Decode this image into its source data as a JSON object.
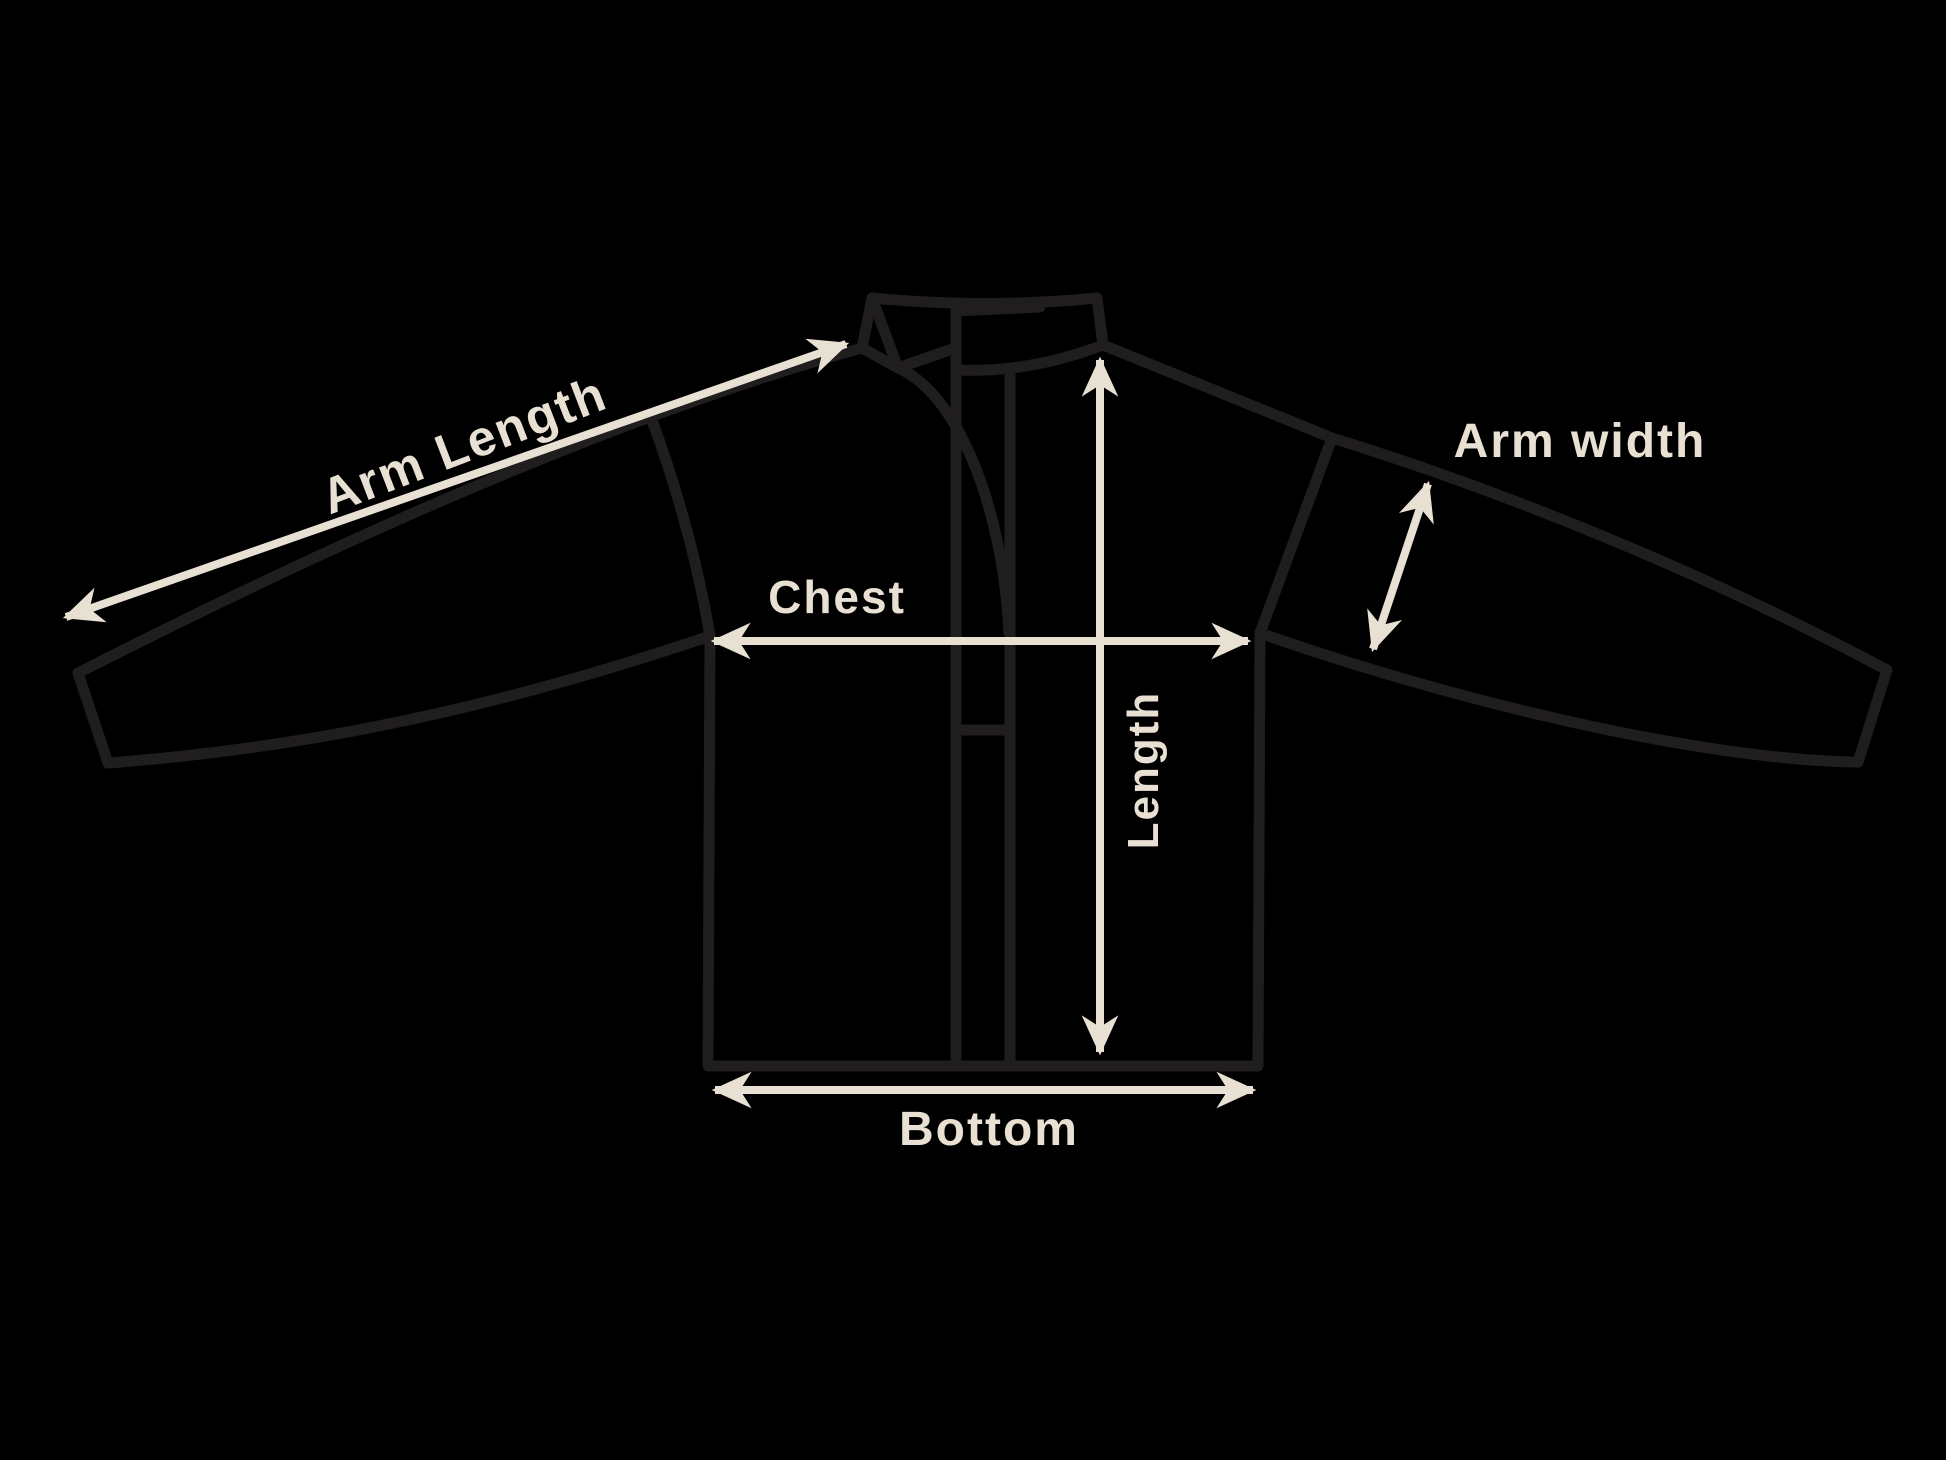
{
  "diagram": {
    "title": "Jacket measurement diagram",
    "colors": {
      "background": "#000000",
      "outline": "#201d1e",
      "accent": "#e8e1d3"
    },
    "labels": {
      "arm_length": {
        "text": "Arm Length"
      },
      "arm_width": {
        "text": "Arm width"
      },
      "chest": {
        "text": "Chest"
      },
      "length": {
        "text": "Length"
      },
      "bottom": {
        "text": "Bottom"
      }
    }
  }
}
